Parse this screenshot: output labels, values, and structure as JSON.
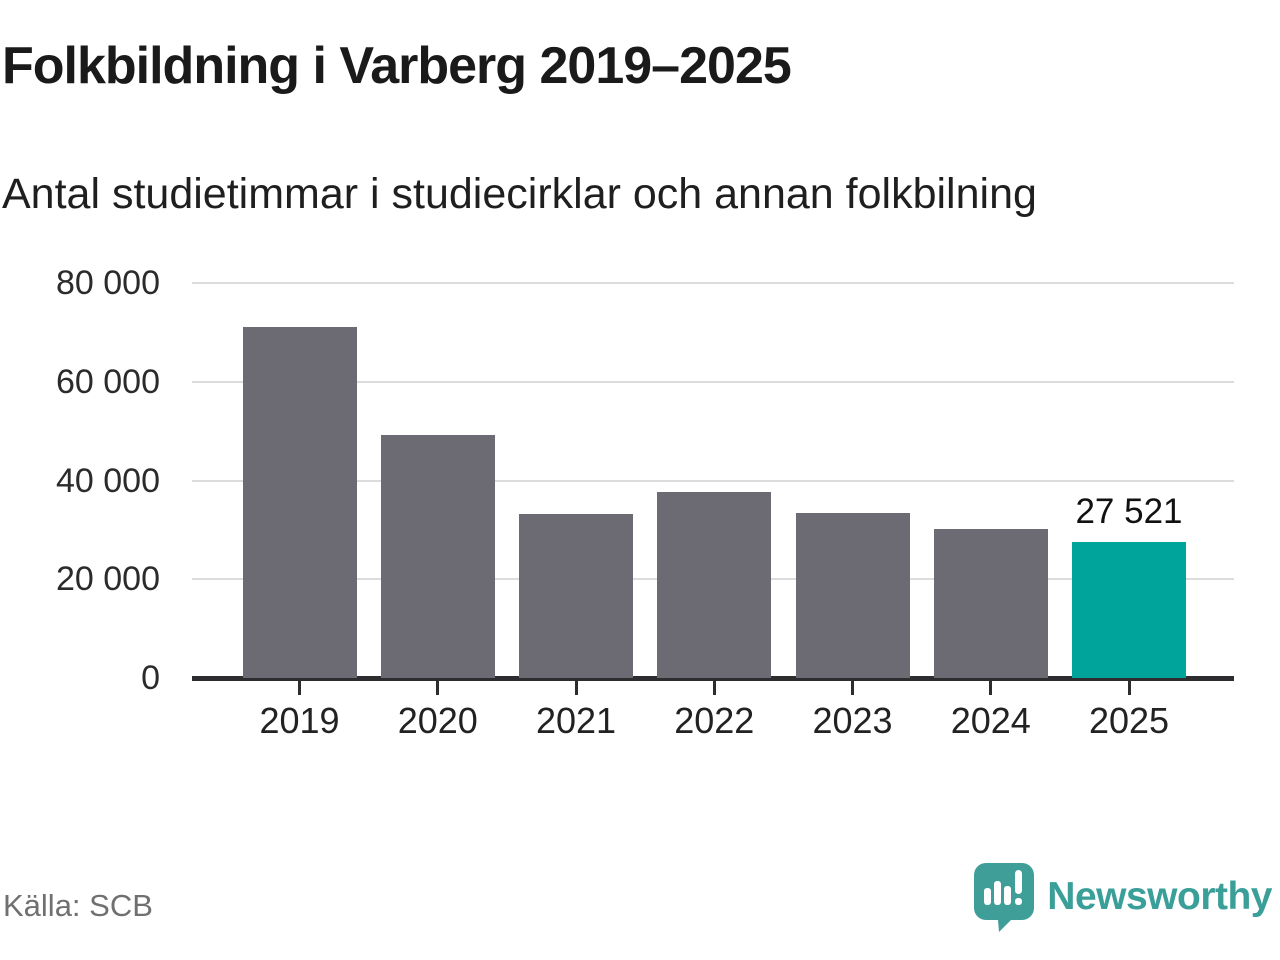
{
  "title": "Folkbildning i Varberg 2019–2025",
  "subtitle": "Antal studietimmar i studiecirklar och annan folkbilning",
  "footer": {
    "source_label": "Källa: SCB",
    "brand": "Newsworthy",
    "logo_icon": "newsworthy-speech-bubble-barchart-icon"
  },
  "colors": {
    "bar": "#6c6b74",
    "highlight": "#00a49b",
    "grid": "#dcdcdc",
    "axis": "#2d2d30",
    "title_text": "#1a1a1a",
    "brand_teal": "#3a9f99",
    "source_text": "#707070"
  },
  "chart_data": {
    "type": "bar",
    "title": "Folkbildning i Varberg 2019–2025",
    "subtitle": "Antal studietimmar i studiecirklar och annan folkbilning",
    "categories": [
      "2019",
      "2020",
      "2021",
      "2022",
      "2023",
      "2024",
      "2025"
    ],
    "values": [
      71000,
      49200,
      33200,
      37600,
      33400,
      30200,
      27521
    ],
    "highlight_index": 6,
    "annotation": {
      "index": 6,
      "text": "27 521"
    },
    "xlabel": "",
    "ylabel": "",
    "ylim": [
      0,
      80000
    ],
    "yticks": [
      0,
      20000,
      40000,
      60000,
      80000
    ],
    "ytick_labels": [
      "0",
      "20 000",
      "40 000",
      "60 000",
      "80 000"
    ],
    "grid": true,
    "legend": "none"
  }
}
